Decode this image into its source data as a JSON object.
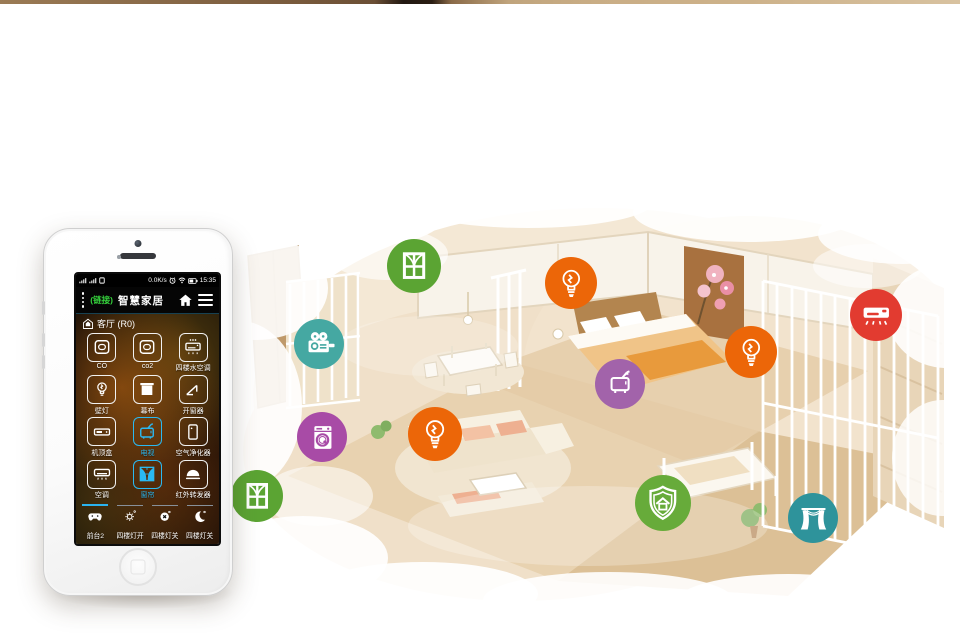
{
  "phone": {
    "status": {
      "speed": "0.0K/s",
      "time": "15:35"
    },
    "header": {
      "link": "(链接)",
      "title": "智慧家居"
    },
    "room": {
      "label": "客厅 (R0)"
    },
    "devices": [
      {
        "label": "CO",
        "icon": "sensor",
        "active": false
      },
      {
        "label": "co2",
        "icon": "sensor",
        "active": false
      },
      {
        "label": "四楼水空调",
        "icon": "ac-top",
        "active": false
      },
      {
        "label": "壁灯",
        "icon": "bulb",
        "active": false
      },
      {
        "label": "幕布",
        "icon": "screen",
        "active": false
      },
      {
        "label": "开窗器",
        "icon": "window-opener",
        "active": false
      },
      {
        "label": "机顶盒",
        "icon": "settop",
        "active": false
      },
      {
        "label": "电视",
        "icon": "tv",
        "active": true
      },
      {
        "label": "空气净化器",
        "icon": "purifier",
        "active": false
      },
      {
        "label": "空调",
        "icon": "ac",
        "active": false
      },
      {
        "label": "窗帘",
        "icon": "curtain",
        "active": true
      },
      {
        "label": "红外转发器",
        "icon": "dome",
        "active": false
      }
    ],
    "scenes": [
      {
        "label": "前台2",
        "icon": "gamepad",
        "active": true
      },
      {
        "label": "四楼灯开",
        "icon": "sun",
        "active": false
      },
      {
        "label": "四楼灯关",
        "icon": "x-circle",
        "active": false
      },
      {
        "label": "四楼灯关",
        "icon": "moon",
        "active": false
      }
    ],
    "accent": "#2ab4f0",
    "link_color": "#35d23c"
  },
  "overlays": [
    {
      "name": "window-icon",
      "icon": "o-window",
      "color": "#5ba433",
      "x": 414,
      "y": 266,
      "d": 54
    },
    {
      "name": "bulb-icon",
      "icon": "o-bulb",
      "color": "#ec6608",
      "x": 571,
      "y": 283,
      "d": 52
    },
    {
      "name": "movie-camera-icon",
      "icon": "o-camera",
      "color": "#45a8a2",
      "x": 319,
      "y": 344,
      "d": 50
    },
    {
      "name": "bulb-icon",
      "icon": "o-bulb",
      "color": "#ec6608",
      "x": 751,
      "y": 352,
      "d": 52
    },
    {
      "name": "tv-icon",
      "icon": "o-tv",
      "color": "#a263aa",
      "x": 620,
      "y": 384,
      "d": 50
    },
    {
      "name": "ac-icon",
      "icon": "o-ac",
      "color": "#e23b30",
      "x": 876,
      "y": 315,
      "d": 52
    },
    {
      "name": "washer-icon",
      "icon": "o-washer",
      "color": "#a84ba6",
      "x": 322,
      "y": 437,
      "d": 50
    },
    {
      "name": "bulb-icon",
      "icon": "o-bulb",
      "color": "#ec6608",
      "x": 435,
      "y": 434,
      "d": 54
    },
    {
      "name": "window-icon",
      "icon": "o-window",
      "color": "#5ba433",
      "x": 257,
      "y": 496,
      "d": 52
    },
    {
      "name": "shield-home-icon",
      "icon": "o-shield",
      "color": "#67ab3a",
      "x": 663,
      "y": 503,
      "d": 56
    },
    {
      "name": "curtain-icon",
      "icon": "o-curtain",
      "color": "#2e939b",
      "x": 813,
      "y": 518,
      "d": 50
    }
  ]
}
